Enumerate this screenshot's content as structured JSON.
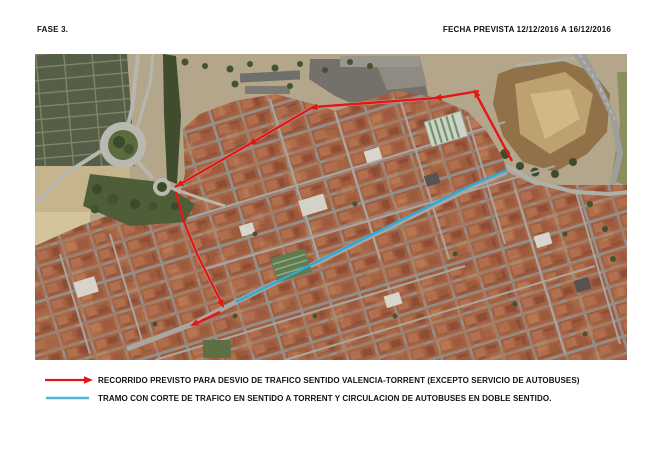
{
  "header": {
    "phase": "FASE 3.",
    "date": "FECHA PREVISTA 12/12/2016 A 16/12/2016"
  },
  "legend": {
    "items": [
      {
        "symbol": "red-arrow",
        "color": "#e31713",
        "label": "RECORRIDO PREVISTO PARA DESVIO DE TRAFICO SENTIDO VALENCIA-TORRENT (EXCEPTO SERVICIO DE AUTOBUSES)"
      },
      {
        "symbol": "blue-line",
        "color": "#4fb3d8",
        "label": "TRAMO CON CORTE DE TRAFICO EN SENTIDO A TORRENT Y CIRCULACION DE AUTOBUSES EN DOBLE SENTIDO."
      }
    ]
  },
  "map": {
    "type": "satellite-aerial",
    "routes": [
      {
        "name": "recorrido-desvio-valencia-torrent",
        "color": "#e31713",
        "width": 2.4,
        "paths": [
          "477,107 441,40",
          "444,37 402,44 278,53 213,91 140,133",
          "141,138 149,168 162,200 176,228 188,252",
          "185,258 158,271"
        ],
        "arrows": [
          [
            439,
            35,
            -115
          ],
          [
            398,
            44,
            175
          ],
          [
            274,
            54,
            172
          ],
          [
            213,
            91,
            150
          ],
          [
            140,
            133,
            150
          ],
          [
            189,
            254,
            62
          ],
          [
            155,
            272,
            155
          ]
        ]
      },
      {
        "name": "tramo-corte-trafico-torrent",
        "color": "#2ea9da",
        "width": 2.4,
        "paths": [
          "472,116 437,131 201,248"
        ],
        "arrows": []
      }
    ]
  }
}
